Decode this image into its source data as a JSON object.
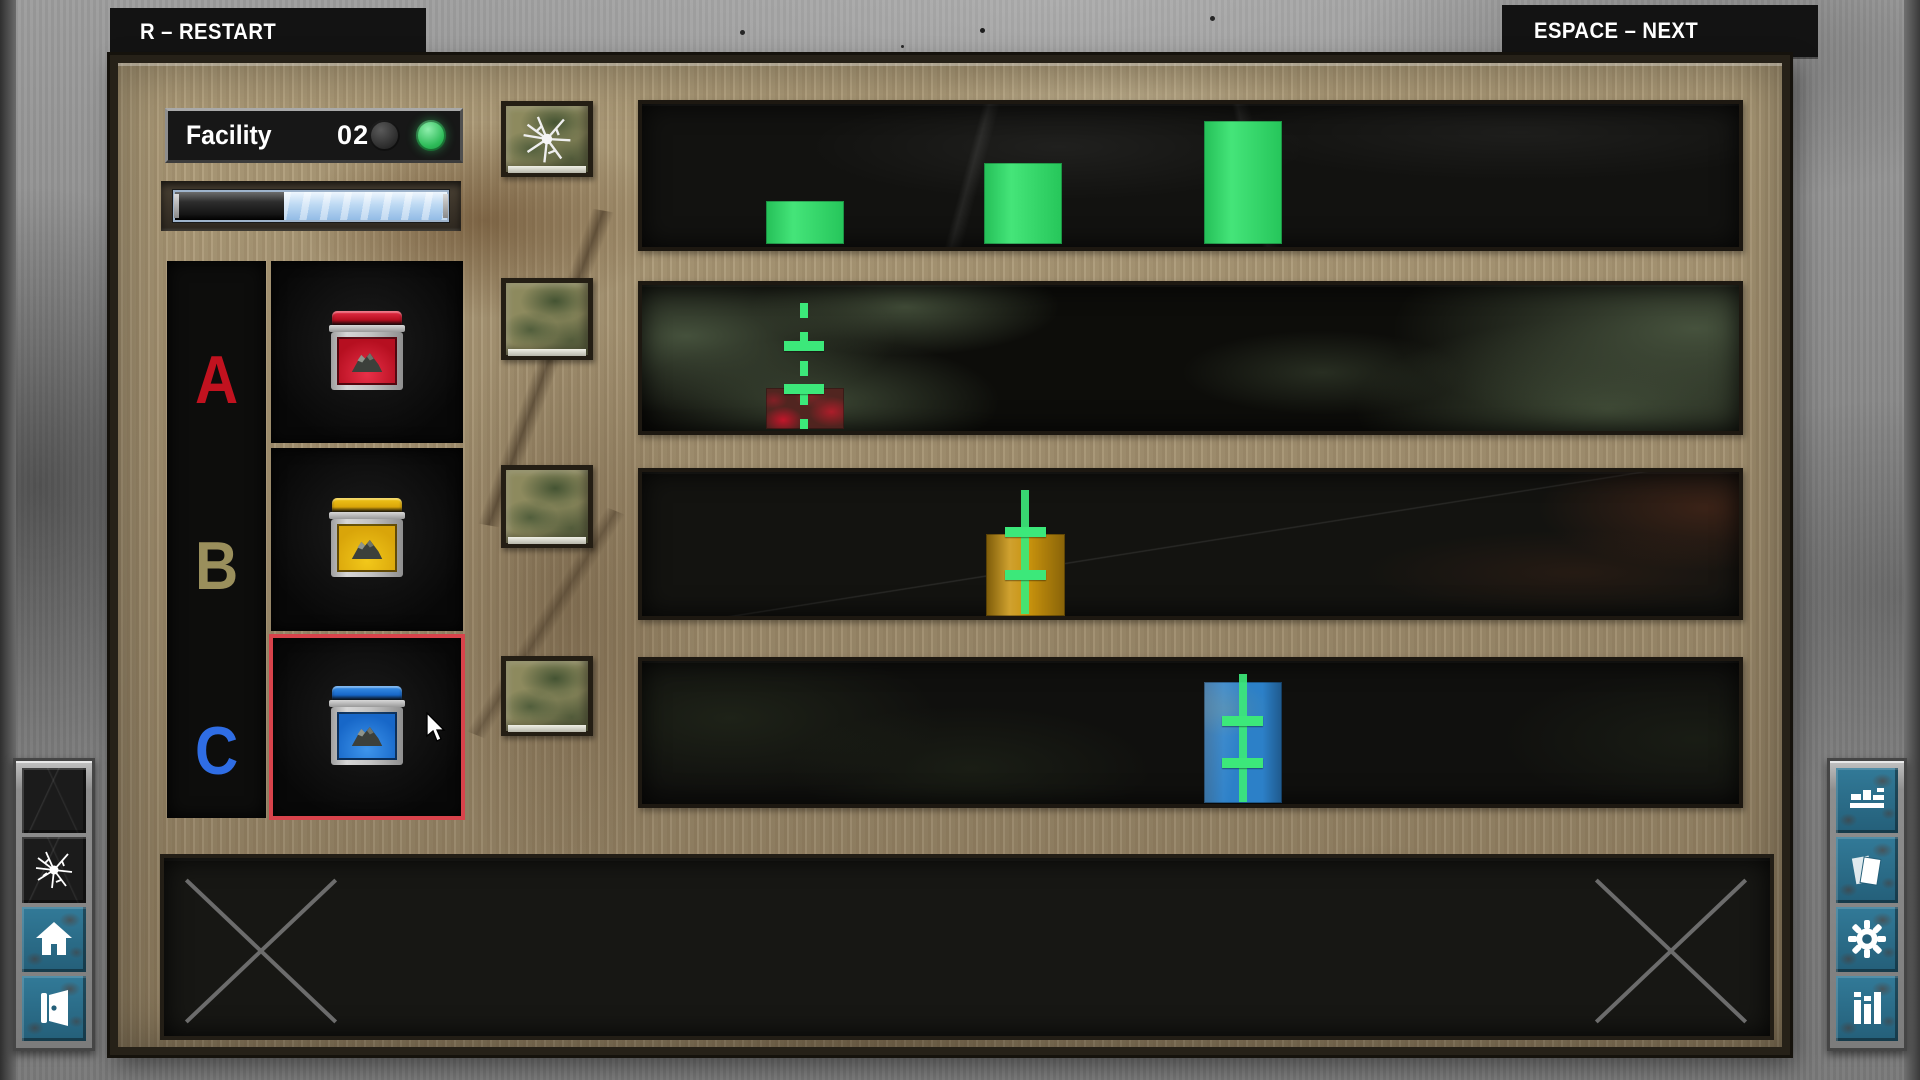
{
  "hud": {
    "restart_hint": "R – RESTART",
    "next_hint": "ESPACE – NEXT"
  },
  "facility": {
    "label": "Facility",
    "number": "02",
    "lights": [
      {
        "name": "power-light-left",
        "on": false
      },
      {
        "name": "power-light-right",
        "on": true,
        "color": "#2dbb58"
      }
    ],
    "progress": {
      "empty_pct": 40,
      "fill_pct": 60,
      "fill_color": "#bdd9f3"
    }
  },
  "materials": [
    {
      "label": "A",
      "letter_color": "#c1121f",
      "jar_color": "#b60f20",
      "jar_light": "#e83048",
      "selected": false
    },
    {
      "label": "B",
      "letter_color": "#9a8f5c",
      "jar_color": "#d9a50a",
      "jar_light": "#f2c81a",
      "selected": false
    },
    {
      "label": "C",
      "letter_color": "#2f6de4",
      "jar_color": "#1767c8",
      "jar_light": "#3e95ec",
      "selected": true
    }
  ],
  "selection_color": "#d8434b",
  "marker_color": "#3ce87a",
  "dispensers": [
    {
      "cracked": true
    },
    {
      "cracked": false
    },
    {
      "cracked": false
    },
    {
      "cracked": false
    }
  ],
  "shelves": [
    {
      "kind": "bars",
      "bar_color": "#2be167",
      "bar_width_pct": 7.1,
      "bars": [
        {
          "left_pct": 11.3,
          "height_pct": 30
        },
        {
          "left_pct": 31.2,
          "height_pct": 57
        },
        {
          "left_pct": 51.2,
          "height_pct": 86
        }
      ]
    },
    {
      "kind": "gauge",
      "texture": "camo",
      "block_color": "#542420",
      "block": {
        "left_pct": 11.3,
        "top_pct": 70.5,
        "width_pct": 7.1,
        "height_pct": 28
      },
      "line": {
        "x_pct": 14.8,
        "top_pct": 12,
        "style": "dashed"
      },
      "ticks": {
        "left_pct": 12.9,
        "width_pct": 3.7,
        "tops_pct": [
          38.4,
          67.5
        ]
      }
    },
    {
      "kind": "gauge",
      "texture": "plain",
      "block_color": "#c8920d",
      "block": {
        "left_pct": 31.4,
        "top_pct": 43,
        "width_pct": 7.2,
        "height_pct": 57
      },
      "line": {
        "x_pct": 34.9,
        "top_pct": 12.5,
        "style": "solid"
      },
      "ticks": {
        "left_pct": 33.1,
        "width_pct": 3.7,
        "tops_pct": [
          38.4,
          67.8
        ]
      }
    },
    {
      "kind": "gauge",
      "texture": "mottle",
      "block_color": "#2c80c8",
      "block": {
        "left_pct": 51.2,
        "top_pct": 14.5,
        "width_pct": 7.1,
        "height_pct": 84.5
      },
      "line": {
        "x_pct": 54.8,
        "top_pct": 9.3,
        "style": "solid"
      },
      "ticks": {
        "left_pct": 52.9,
        "width_pct": 3.7,
        "tops_pct": [
          38.4,
          67.5
        ]
      }
    }
  ],
  "toolbars": {
    "accent": "#2b7290",
    "left": [
      "blank-slot",
      "shatter",
      "home",
      "exit"
    ],
    "right": [
      "conveyor",
      "notes",
      "settings",
      "stats"
    ]
  }
}
